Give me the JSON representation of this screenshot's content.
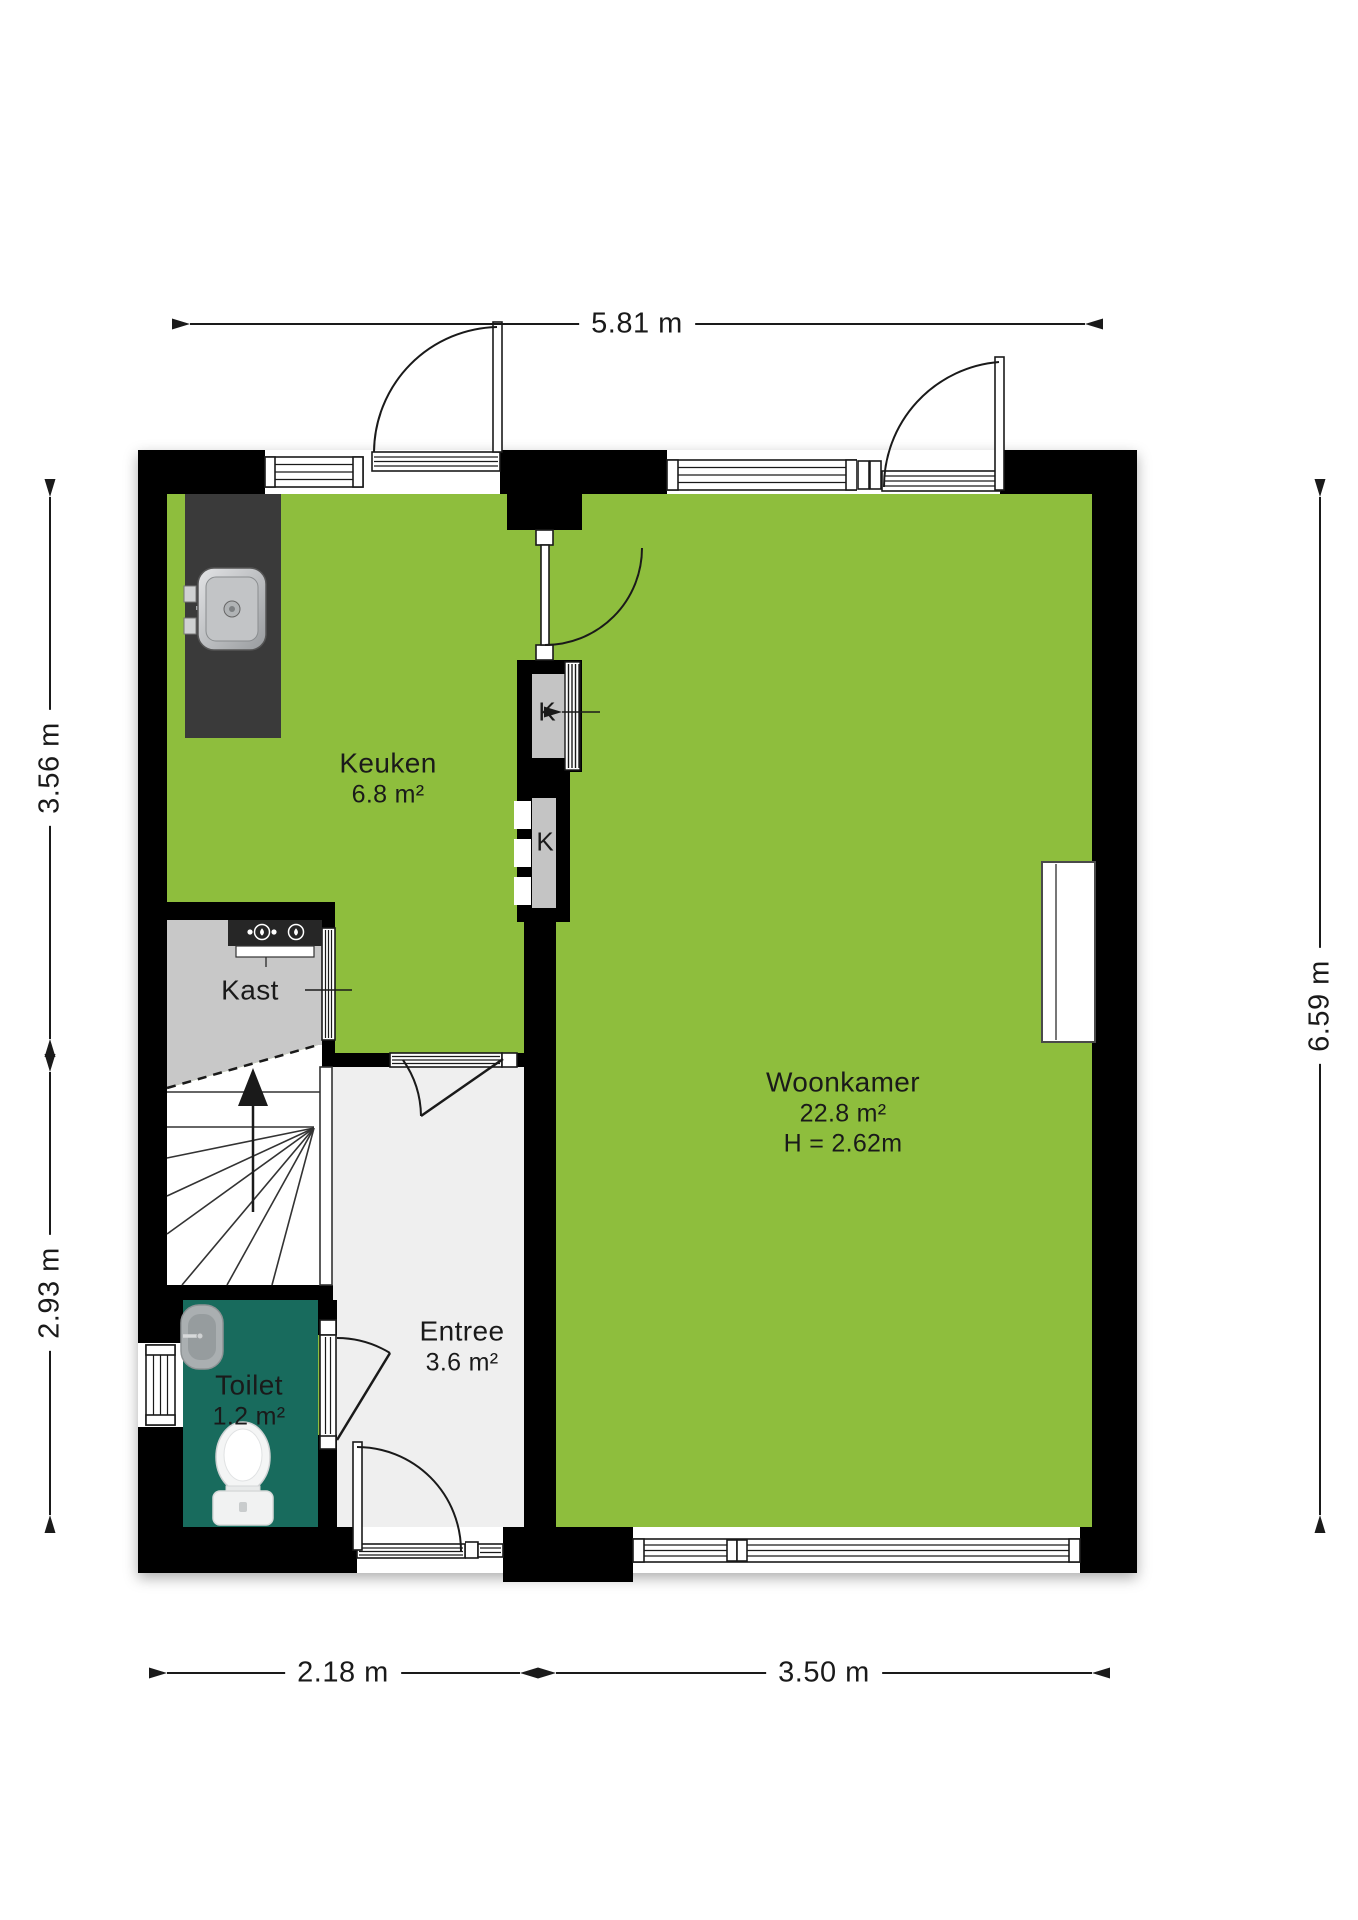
{
  "rooms": {
    "keuken": {
      "name": "Keuken",
      "area": "6.8 m²"
    },
    "woonkamer": {
      "name": "Woonkamer",
      "area": "22.8 m²",
      "ceiling_height": "H = 2.62m"
    },
    "entree": {
      "name": "Entree",
      "area": "3.6 m²"
    },
    "toilet": {
      "name": "Toilet",
      "area": "1.2 m²"
    },
    "kast": {
      "name": "Kast"
    },
    "closet_top": {
      "label": "K"
    },
    "closet_bottom": {
      "label": "K"
    }
  },
  "dimensions": {
    "top": "5.81 m",
    "left_upper": "3.56 m",
    "left_lower": "2.93 m",
    "right": "6.59 m",
    "bottom_left": "2.18 m",
    "bottom_right": "3.50 m"
  },
  "icons": [
    "kitchen-sink-icon",
    "boiler-icon",
    "toilet-icon",
    "washbasin-icon",
    "radiator-icon",
    "stairs-up-arrow-icon"
  ],
  "colors": {
    "room": "#8ebe3d",
    "toilet": "#186b5d",
    "kast": "#c8c8c8",
    "entree": "#efefef",
    "wall": "#000000",
    "counter": "#3a3a3a"
  }
}
